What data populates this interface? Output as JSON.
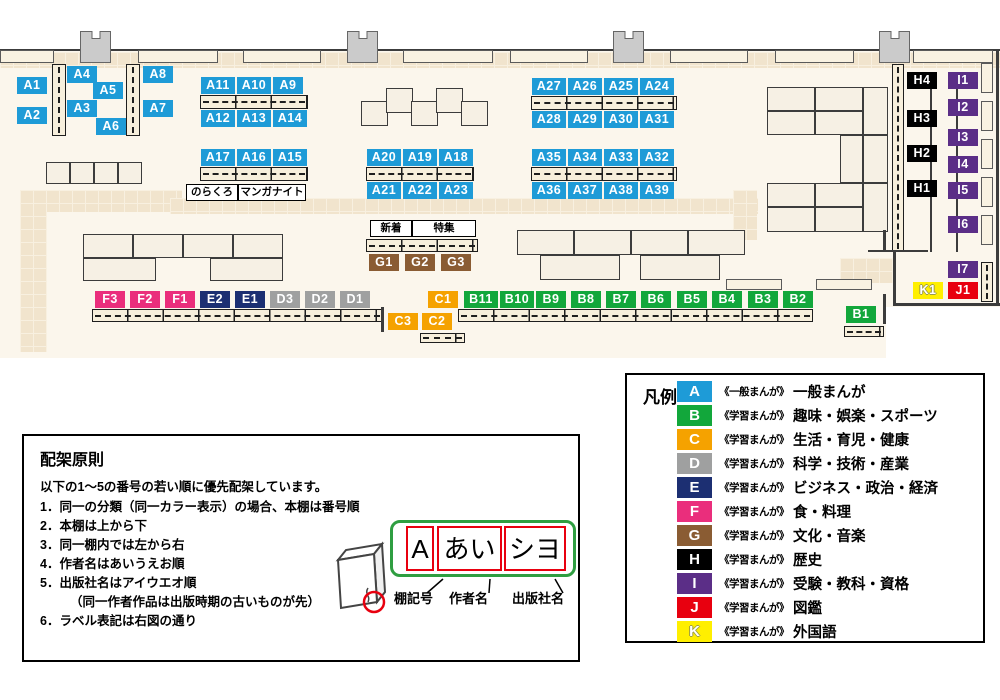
{
  "colors": {
    "A": "#1e9bd7",
    "B": "#12a73b",
    "C": "#f5a200",
    "D": "#9fa0a0",
    "E": "#1c2f72",
    "F": "#ea2e7c",
    "G": "#8a5c33",
    "H": "#000000",
    "I": "#5b2e87",
    "J": "#e8000f",
    "K": "#ffef00"
  },
  "map": {
    "shapes": [
      {
        "t": "floor",
        "x": 0,
        "y": 51,
        "w": 1000,
        "h": 307
      },
      {
        "t": "hatch",
        "x": 0,
        "y": 52,
        "w": 1000,
        "h": 16
      },
      {
        "t": "hatch",
        "x": 20,
        "y": 190,
        "w": 162,
        "h": 22
      },
      {
        "t": "hatch",
        "x": 20,
        "y": 190,
        "w": 27,
        "h": 162
      },
      {
        "t": "hatch",
        "x": 170,
        "y": 198,
        "w": 588,
        "h": 16
      },
      {
        "t": "hatch",
        "x": 733,
        "y": 190,
        "w": 24,
        "h": 50
      },
      {
        "t": "hatch",
        "x": 840,
        "y": 258,
        "w": 54,
        "h": 25
      },
      {
        "t": "hline",
        "x": 0,
        "y": 49,
        "w": 1000,
        "h": 2
      },
      {
        "t": "wallseg",
        "x": 0,
        "y": 50,
        "w": 54,
        "h": 13
      },
      {
        "t": "wallseg",
        "x": 138,
        "y": 50,
        "w": 80,
        "h": 13
      },
      {
        "t": "wallseg",
        "x": 243,
        "y": 50,
        "w": 78,
        "h": 13
      },
      {
        "t": "wallseg",
        "x": 403,
        "y": 50,
        "w": 90,
        "h": 13
      },
      {
        "t": "wallseg",
        "x": 510,
        "y": 50,
        "w": 78,
        "h": 13
      },
      {
        "t": "wallseg",
        "x": 670,
        "y": 50,
        "w": 78,
        "h": 13
      },
      {
        "t": "wallseg",
        "x": 775,
        "y": 50,
        "w": 79,
        "h": 13
      },
      {
        "t": "wallseg",
        "x": 913,
        "y": 50,
        "w": 80,
        "h": 13
      },
      {
        "t": "pillar",
        "x": 80,
        "y": 31,
        "w": 31,
        "h": 32
      },
      {
        "t": "pillar",
        "x": 347,
        "y": 31,
        "w": 31,
        "h": 32
      },
      {
        "t": "pillar",
        "x": 613,
        "y": 31,
        "w": 31,
        "h": 32
      },
      {
        "t": "pillar",
        "x": 879,
        "y": 31,
        "w": 31,
        "h": 32
      },
      {
        "t": "block",
        "x": 46,
        "y": 162,
        "w": 24,
        "h": 22
      },
      {
        "t": "block",
        "x": 70,
        "y": 162,
        "w": 24,
        "h": 22
      },
      {
        "t": "block",
        "x": 94,
        "y": 162,
        "w": 24,
        "h": 22
      },
      {
        "t": "block",
        "x": 118,
        "y": 162,
        "w": 24,
        "h": 22
      },
      {
        "t": "block",
        "x": 361,
        "y": 101,
        "w": 27,
        "h": 25
      },
      {
        "t": "block",
        "x": 386,
        "y": 88,
        "w": 27,
        "h": 25
      },
      {
        "t": "block",
        "x": 411,
        "y": 101,
        "w": 27,
        "h": 25
      },
      {
        "t": "block",
        "x": 436,
        "y": 88,
        "w": 27,
        "h": 25
      },
      {
        "t": "block",
        "x": 461,
        "y": 101,
        "w": 27,
        "h": 25
      },
      {
        "t": "block",
        "x": 83,
        "y": 234,
        "w": 50,
        "h": 24
      },
      {
        "t": "block",
        "x": 133,
        "y": 234,
        "w": 50,
        "h": 24
      },
      {
        "t": "block",
        "x": 183,
        "y": 234,
        "w": 50,
        "h": 24
      },
      {
        "t": "block",
        "x": 233,
        "y": 234,
        "w": 50,
        "h": 24
      },
      {
        "t": "block",
        "x": 83,
        "y": 258,
        "w": 73,
        "h": 23
      },
      {
        "t": "block",
        "x": 210,
        "y": 258,
        "w": 73,
        "h": 23
      },
      {
        "t": "block",
        "x": 517,
        "y": 230,
        "w": 57,
        "h": 25
      },
      {
        "t": "block",
        "x": 574,
        "y": 230,
        "w": 57,
        "h": 25
      },
      {
        "t": "block",
        "x": 631,
        "y": 230,
        "w": 57,
        "h": 25
      },
      {
        "t": "block",
        "x": 688,
        "y": 230,
        "w": 57,
        "h": 25
      },
      {
        "t": "block",
        "x": 540,
        "y": 255,
        "w": 80,
        "h": 25
      },
      {
        "t": "block",
        "x": 640,
        "y": 255,
        "w": 80,
        "h": 25
      },
      {
        "t": "wallseg",
        "x": 726,
        "y": 279,
        "w": 56,
        "h": 11
      },
      {
        "t": "wallseg",
        "x": 816,
        "y": 279,
        "w": 56,
        "h": 11
      },
      {
        "t": "block",
        "x": 767,
        "y": 87,
        "w": 48,
        "h": 24
      },
      {
        "t": "block",
        "x": 815,
        "y": 87,
        "w": 48,
        "h": 24
      },
      {
        "t": "block",
        "x": 767,
        "y": 111,
        "w": 48,
        "h": 24
      },
      {
        "t": "block",
        "x": 815,
        "y": 111,
        "w": 48,
        "h": 24
      },
      {
        "t": "block",
        "x": 863,
        "y": 87,
        "w": 25,
        "h": 48
      },
      {
        "t": "block",
        "x": 840,
        "y": 135,
        "w": 23,
        "h": 48
      },
      {
        "t": "block",
        "x": 863,
        "y": 135,
        "w": 25,
        "h": 48
      },
      {
        "t": "block",
        "x": 767,
        "y": 183,
        "w": 48,
        "h": 24
      },
      {
        "t": "block",
        "x": 815,
        "y": 183,
        "w": 48,
        "h": 24
      },
      {
        "t": "block",
        "x": 767,
        "y": 207,
        "w": 48,
        "h": 25
      },
      {
        "t": "block",
        "x": 815,
        "y": 207,
        "w": 48,
        "h": 25
      },
      {
        "t": "block",
        "x": 863,
        "y": 183,
        "w": 25,
        "h": 49
      },
      {
        "t": "shelfh",
        "x": 200,
        "y": 95,
        "w": 108,
        "h": 14
      },
      {
        "t": "shelfh",
        "x": 200,
        "y": 167,
        "w": 108,
        "h": 14
      },
      {
        "t": "shelfh",
        "x": 366,
        "y": 167,
        "w": 108,
        "h": 14
      },
      {
        "t": "shelfh",
        "x": 531,
        "y": 96,
        "w": 146,
        "h": 14
      },
      {
        "t": "shelfh",
        "x": 531,
        "y": 167,
        "w": 146,
        "h": 14
      },
      {
        "t": "shelfh",
        "x": 366,
        "y": 239,
        "w": 112,
        "h": 13
      },
      {
        "t": "shelfh",
        "x": 92,
        "y": 309,
        "w": 291,
        "h": 13
      },
      {
        "t": "shelfh",
        "x": 458,
        "y": 309,
        "w": 355,
        "h": 13
      },
      {
        "t": "shelfh",
        "x": 420,
        "y": 333,
        "w": 45,
        "h": 10
      },
      {
        "t": "shelfh",
        "x": 844,
        "y": 326,
        "w": 40,
        "h": 11
      },
      {
        "t": "shelfv",
        "x": 52,
        "y": 64,
        "w": 14,
        "h": 72
      },
      {
        "t": "shelfv",
        "x": 126,
        "y": 64,
        "w": 14,
        "h": 72
      },
      {
        "t": "shelfv",
        "x": 892,
        "y": 64,
        "w": 12,
        "h": 188
      },
      {
        "t": "shelfv",
        "x": 981,
        "y": 262,
        "w": 12,
        "h": 40
      },
      {
        "t": "wallseg",
        "x": 981,
        "y": 63,
        "w": 12,
        "h": 30
      },
      {
        "t": "wallseg",
        "x": 981,
        "y": 101,
        "w": 12,
        "h": 30
      },
      {
        "t": "wallseg",
        "x": 981,
        "y": 139,
        "w": 12,
        "h": 30
      },
      {
        "t": "wallseg",
        "x": 981,
        "y": 177,
        "w": 12,
        "h": 30
      },
      {
        "t": "wallseg",
        "x": 981,
        "y": 215,
        "w": 12,
        "h": 30
      },
      {
        "t": "vline",
        "x": 930,
        "y": 72,
        "w": 2,
        "h": 180
      },
      {
        "t": "vline",
        "x": 956,
        "y": 72,
        "w": 2,
        "h": 180
      },
      {
        "t": "hline",
        "x": 868,
        "y": 250,
        "w": 60,
        "h": 2
      },
      {
        "t": "vline",
        "x": 883,
        "y": 230,
        "w": 3,
        "h": 22
      },
      {
        "t": "vline",
        "x": 893,
        "y": 250,
        "w": 3,
        "h": 56
      },
      {
        "t": "hline",
        "x": 893,
        "y": 303,
        "w": 107,
        "h": 3
      },
      {
        "t": "vline",
        "x": 883,
        "y": 294,
        "w": 3,
        "h": 30
      },
      {
        "t": "vline",
        "x": 996,
        "y": 49,
        "w": 3,
        "h": 257
      },
      {
        "t": "vline",
        "x": 381,
        "y": 307,
        "w": 3,
        "h": 25
      },
      {
        "t": "white",
        "x": 886,
        "y": 307,
        "w": 114,
        "h": 52
      }
    ],
    "labels": [
      {
        "t": "A1",
        "x": 17,
        "y": 77
      },
      {
        "t": "A2",
        "x": 17,
        "y": 107
      },
      {
        "t": "A4",
        "x": 67,
        "y": 66
      },
      {
        "t": "A5",
        "x": 93,
        "y": 82
      },
      {
        "t": "A3",
        "x": 67,
        "y": 100
      },
      {
        "t": "A6",
        "x": 96,
        "y": 118
      },
      {
        "t": "A8",
        "x": 143,
        "y": 66
      },
      {
        "t": "A7",
        "x": 143,
        "y": 100
      },
      {
        "t": "A11",
        "x": 201,
        "y": 77
      },
      {
        "t": "A10",
        "x": 237,
        "y": 77
      },
      {
        "t": "A9",
        "x": 273,
        "y": 77
      },
      {
        "t": "A12",
        "x": 201,
        "y": 110
      },
      {
        "t": "A13",
        "x": 237,
        "y": 110
      },
      {
        "t": "A14",
        "x": 273,
        "y": 110
      },
      {
        "t": "A17",
        "x": 201,
        "y": 149
      },
      {
        "t": "A16",
        "x": 237,
        "y": 149
      },
      {
        "t": "A15",
        "x": 273,
        "y": 149
      },
      {
        "t": "A20",
        "x": 367,
        "y": 149
      },
      {
        "t": "A19",
        "x": 403,
        "y": 149
      },
      {
        "t": "A18",
        "x": 439,
        "y": 149
      },
      {
        "t": "A21",
        "x": 367,
        "y": 182
      },
      {
        "t": "A22",
        "x": 403,
        "y": 182
      },
      {
        "t": "A23",
        "x": 439,
        "y": 182
      },
      {
        "t": "A27",
        "x": 532,
        "y": 78
      },
      {
        "t": "A26",
        "x": 568,
        "y": 78
      },
      {
        "t": "A25",
        "x": 604,
        "y": 78
      },
      {
        "t": "A24",
        "x": 640,
        "y": 78
      },
      {
        "t": "A28",
        "x": 532,
        "y": 111
      },
      {
        "t": "A29",
        "x": 568,
        "y": 111
      },
      {
        "t": "A30",
        "x": 604,
        "y": 111
      },
      {
        "t": "A31",
        "x": 640,
        "y": 111
      },
      {
        "t": "A35",
        "x": 532,
        "y": 149
      },
      {
        "t": "A34",
        "x": 568,
        "y": 149
      },
      {
        "t": "A33",
        "x": 604,
        "y": 149
      },
      {
        "t": "A32",
        "x": 640,
        "y": 149
      },
      {
        "t": "A36",
        "x": 532,
        "y": 182
      },
      {
        "t": "A37",
        "x": 568,
        "y": 182
      },
      {
        "t": "A38",
        "x": 604,
        "y": 182
      },
      {
        "t": "A39",
        "x": 640,
        "y": 182
      },
      {
        "t": "G1",
        "x": 369,
        "y": 254
      },
      {
        "t": "G2",
        "x": 405,
        "y": 254
      },
      {
        "t": "G3",
        "x": 441,
        "y": 254
      },
      {
        "t": "F3",
        "x": 95,
        "y": 291
      },
      {
        "t": "F2",
        "x": 130,
        "y": 291
      },
      {
        "t": "F1",
        "x": 165,
        "y": 291
      },
      {
        "t": "E2",
        "x": 200,
        "y": 291
      },
      {
        "t": "E1",
        "x": 235,
        "y": 291
      },
      {
        "t": "D3",
        "x": 270,
        "y": 291
      },
      {
        "t": "D2",
        "x": 305,
        "y": 291
      },
      {
        "t": "D1",
        "x": 340,
        "y": 291
      },
      {
        "t": "C1",
        "x": 428,
        "y": 291
      },
      {
        "t": "B11",
        "x": 464,
        "y": 291
      },
      {
        "t": "B10",
        "x": 500,
        "y": 291
      },
      {
        "t": "B9",
        "x": 536,
        "y": 291
      },
      {
        "t": "B8",
        "x": 571,
        "y": 291
      },
      {
        "t": "B7",
        "x": 606,
        "y": 291
      },
      {
        "t": "B6",
        "x": 641,
        "y": 291
      },
      {
        "t": "B5",
        "x": 677,
        "y": 291
      },
      {
        "t": "B4",
        "x": 712,
        "y": 291
      },
      {
        "t": "B3",
        "x": 748,
        "y": 291
      },
      {
        "t": "B2",
        "x": 783,
        "y": 291
      },
      {
        "t": "C3",
        "x": 388,
        "y": 313
      },
      {
        "t": "C2",
        "x": 422,
        "y": 313
      },
      {
        "t": "B1",
        "x": 846,
        "y": 306
      },
      {
        "t": "H4",
        "x": 907,
        "y": 72
      },
      {
        "t": "H3",
        "x": 907,
        "y": 110
      },
      {
        "t": "H2",
        "x": 907,
        "y": 145
      },
      {
        "t": "H1",
        "x": 907,
        "y": 180
      },
      {
        "t": "I1",
        "x": 948,
        "y": 72
      },
      {
        "t": "I2",
        "x": 948,
        "y": 99
      },
      {
        "t": "I3",
        "x": 948,
        "y": 129
      },
      {
        "t": "I4",
        "x": 948,
        "y": 156
      },
      {
        "t": "I5",
        "x": 948,
        "y": 182
      },
      {
        "t": "I6",
        "x": 948,
        "y": 216
      },
      {
        "t": "I7",
        "x": 948,
        "y": 261
      },
      {
        "t": "K1",
        "x": 913,
        "y": 282
      },
      {
        "t": "J1",
        "x": 948,
        "y": 282
      }
    ],
    "tags": [
      {
        "t": "のらくろ",
        "x": 186,
        "y": 184,
        "w": 50
      },
      {
        "t": "マンガナイト",
        "x": 238,
        "y": 184,
        "w": 66
      },
      {
        "t": "新着",
        "x": 370,
        "y": 220,
        "w": 40
      },
      {
        "t": "特集",
        "x": 412,
        "y": 220,
        "w": 62
      }
    ]
  },
  "legend": {
    "title": "凡例",
    "rows": [
      {
        "letter": "A",
        "series": "《一般まんが》",
        "category": "一般まんが"
      },
      {
        "letter": "B",
        "series": "《学習まんが》",
        "category": "趣味・娯楽・スポーツ"
      },
      {
        "letter": "C",
        "series": "《学習まんが》",
        "category": "生活・育児・健康"
      },
      {
        "letter": "D",
        "series": "《学習まんが》",
        "category": "科学・技術・産業"
      },
      {
        "letter": "E",
        "series": "《学習まんが》",
        "category": "ビジネス・政治・経済"
      },
      {
        "letter": "F",
        "series": "《学習まんが》",
        "category": "食・料理"
      },
      {
        "letter": "G",
        "series": "《学習まんが》",
        "category": "文化・音楽"
      },
      {
        "letter": "H",
        "series": "《学習まんが》",
        "category": "歴史"
      },
      {
        "letter": "I",
        "series": "《学習まんが》",
        "category": "受験・教科・資格"
      },
      {
        "letter": "J",
        "series": "《学習まんが》",
        "category": "図鑑"
      },
      {
        "letter": "K",
        "series": "《学習まんが》",
        "category": "外国語"
      }
    ]
  },
  "principles": {
    "title": "配架原則",
    "intro": "以下の1～5の番号の若い順に優先配架しています。",
    "items": [
      "1．同一の分類（同一カラー表示）の場合、本棚は番号順",
      "2．本棚は上から下",
      "3．同一棚内では左から右",
      "4．作者名はあいうえお順",
      "5．出版社名はアイウエオ順",
      "（同一作者作品は出版時期の古いものが先）",
      "6．ラベル表記は右図の通り"
    ],
    "diagram": {
      "label_boxes": [
        {
          "text": "A",
          "x": 13,
          "w": 28
        },
        {
          "text": "あい",
          "x": 44,
          "w": 65
        },
        {
          "text": "シヨ",
          "x": 111,
          "w": 62
        }
      ],
      "callouts": [
        {
          "text": "棚記号",
          "x": 370
        },
        {
          "text": "作者名",
          "x": 425
        },
        {
          "text": "出版社名",
          "x": 488
        }
      ]
    }
  }
}
